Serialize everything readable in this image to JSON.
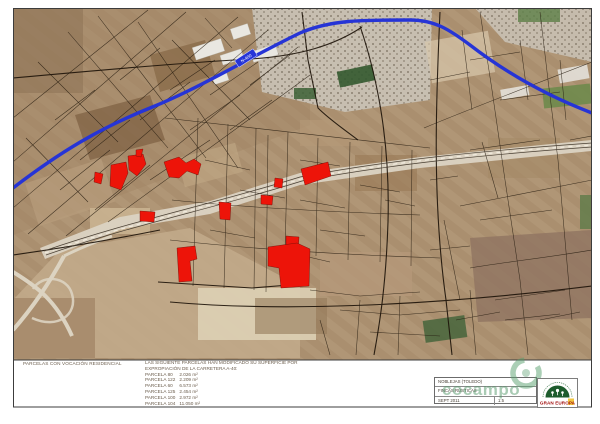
{
  "map": {
    "road_label": "N-400",
    "colors": {
      "road_blue": "#2634d6",
      "red_parcel": "#ed1409",
      "parcel_line": "#241a0e",
      "cocampo_green": "#55996b",
      "gran_europa_green": "#1d5c2d",
      "gran_europa_red": "#a31212"
    },
    "red_parcels": [
      "111,165 126,162 128,173 121,190 110,186",
      "128,156 143,154 146,164 137,176 129,170",
      "136,150 143,149 141,157 136,156",
      "164,162 179,157 186,163 194,159 201,164 198,175 187,171 179,178 169,177",
      "275,178 283,179 282,188 274,187",
      "261,195 273,196 272,205 261,204",
      "219,202 231,203 230,220 220,219",
      "140,211 155,212 154,222 140,221",
      "286,236 299,237 298,251 286,250",
      "301,169 328,162 331,176 305,185",
      "177,248 195,246 197,259 190,261 192,281 179,282",
      "268,247 297,243 310,249 309,286 281,288 279,268 268,266",
      "95,172 103,174 101,184 94,182"
    ]
  },
  "footer": {
    "left_label": "PARCELAS CON VOCACIÓN RESIDENCIAL",
    "note_line1": "LAS SIGUIENTE PARCELAS HAN MODIFICADO SU SUPERFICIE POR",
    "note_line2": "EXPROPIACIÓN DE LA CARRETERA A-40:",
    "parcels": [
      {
        "label": "PARCELA 80",
        "area": "2.026 m²"
      },
      {
        "label": "PARCELA 122",
        "area": "2.209 m²"
      },
      {
        "label": "PARCELA 60",
        "area": "6.573 m²"
      },
      {
        "label": "PARCELA 125",
        "area": "2.454 m²"
      },
      {
        "label": "PARCELA 100",
        "area": "2.972 m²"
      },
      {
        "label": "PARCELA 104",
        "area": "11.050 m²"
      }
    ]
  },
  "title_block": {
    "location": "NOBLEJAS (TOLEDO)",
    "type": "FINCAS RÚSTICAS",
    "date": "SEPT 2011",
    "scale": "1:5"
  },
  "logos": {
    "watermark": "cocampo",
    "company": "GRAN EUROPA"
  }
}
